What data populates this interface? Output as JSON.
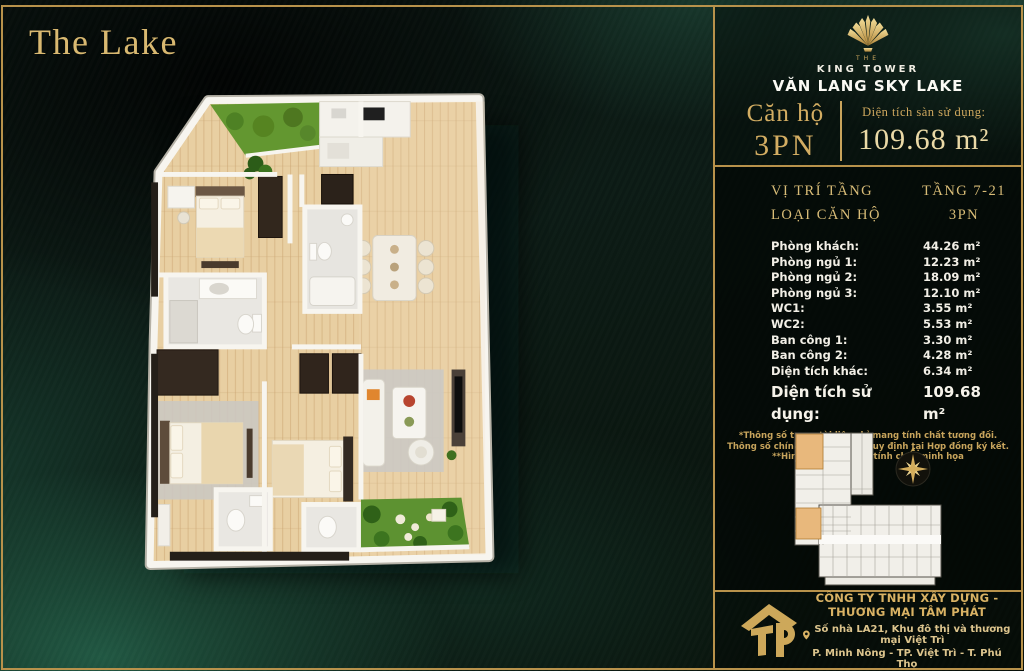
{
  "poster": {
    "title": "The Lake"
  },
  "brand": {
    "pre": "THE",
    "name": "KING TOWER",
    "subname": "VĂN LANG SKY LAKE"
  },
  "unit": {
    "label": "Căn hộ",
    "type": "3PN",
    "area_label": "Diện tích sàn sử dụng:",
    "area_value": "109.68 m²"
  },
  "specs": {
    "floor_label": "VỊ TRÍ TẦNG",
    "floor_value": "TẦNG 7-21",
    "type_label": "LOẠI CĂN HỘ",
    "type_value": "3PN",
    "rows": [
      {
        "label": "Phòng khách:",
        "value": "44.26 m²"
      },
      {
        "label": "Phòng ngủ 1:",
        "value": "12.23 m²"
      },
      {
        "label": "Phòng ngủ 2:",
        "value": "18.09 m²"
      },
      {
        "label": "Phòng ngủ 3:",
        "value": "12.10 m²"
      },
      {
        "label": "WC1:",
        "value": "3.55 m²"
      },
      {
        "label": "WC2:",
        "value": "5.53 m²"
      },
      {
        "label": "Ban công 1:",
        "value": "3.30 m²"
      },
      {
        "label": "Ban công 2:",
        "value": "4.28 m²"
      },
      {
        "label": "Diện tích khác:",
        "value": "6.34 m²"
      }
    ],
    "total": {
      "label": "Diện tích sử dụng:",
      "value": "109.68 m²"
    },
    "notes": [
      "*Thông số trong tài liệu chỉ mang tính chất tương đối.",
      "Thông số chính thức sẽ được quy định tại Hợp đồng ký kết.",
      "**Hình ảnh chỉ mang tính chất minh họa"
    ]
  },
  "footer": {
    "monogram": "TP",
    "company": "CÔNG TY TNHH XÂY DỰNG - THƯƠNG MẠI TÂM PHÁT",
    "address_line1": "Số nhà LA21, Khu đô thị và thương mại Việt Trì",
    "address_line2": "P. Minh Nông - TP. Việt Trì - T. Phú Thọ"
  },
  "icons": {
    "brand_logo": "lotus-fan-icon",
    "compass": "compass-star-icon",
    "pin": "map-pin-icon",
    "company_logo": "tp-house-icon"
  },
  "colors": {
    "gold": "#c9a45c",
    "gold_bright": "#ead9a6",
    "fabric_green": "#1d5743",
    "text_cream": "#f2efe6",
    "highlight_unit_orange": "#e8b87c",
    "wood_floor": "#e8cfa2",
    "garden_green": "#639730"
  }
}
